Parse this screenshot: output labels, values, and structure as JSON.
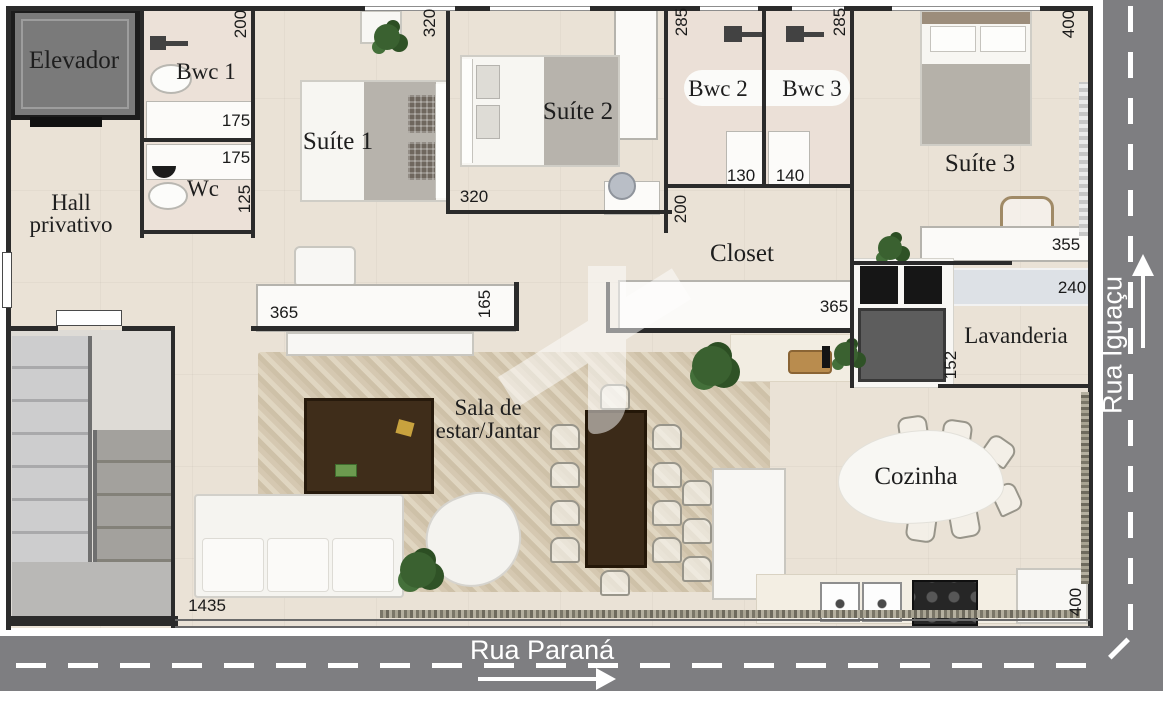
{
  "streets": {
    "bottom": "Rua Paraná",
    "right": "Rua Iguaçu"
  },
  "rooms": {
    "elevator": "Elevador",
    "bwc1": "Bwc 1",
    "wc": "Wc",
    "hall_line1": "Hall",
    "hall_line2": "privativo",
    "suite1": "Suíte 1",
    "suite2": "Suíte 2",
    "bwc2": "Bwc 2",
    "bwc3": "Bwc 3",
    "suite3": "Suíte 3",
    "closet": "Closet",
    "laundry": "Lavanderia",
    "living_line1": "Sala de",
    "living_line2": "estar/Jantar",
    "kitchen": "Cozinha"
  },
  "dimensions": {
    "bwc1_width": "200",
    "suite1_top": "320",
    "bwc2_top": "285",
    "bwc3_top": "285",
    "suite3_top": "400",
    "bwc1_vanity": "175",
    "wc_vanity": "175",
    "wc_depth": "125",
    "suite2_bottom": "320",
    "bwc2_vanity": "130",
    "bwc3_vanity": "140",
    "closet_wall": "200",
    "suite3_desk": "355",
    "suite3_shelf": "240",
    "suite1_wardrobe": "365",
    "suite1_wardrobe_depth": "165",
    "closet_wardrobe": "365",
    "laundry_depth": "152",
    "living_width": "1435",
    "kitchen_counter": "400"
  },
  "colors": {
    "street": "#7e7e81",
    "wall": "#2b2b2b",
    "floor": "#eae2d6",
    "rug": "#d6c9b2",
    "wood_dark": "#3f2d1a",
    "appliance_black": "#161616",
    "appliance_gray": "#5d5d5d",
    "shelf_blue": "#dde1e6",
    "plant_green": "#3a6130",
    "furniture_white": "#f8f7f4"
  }
}
